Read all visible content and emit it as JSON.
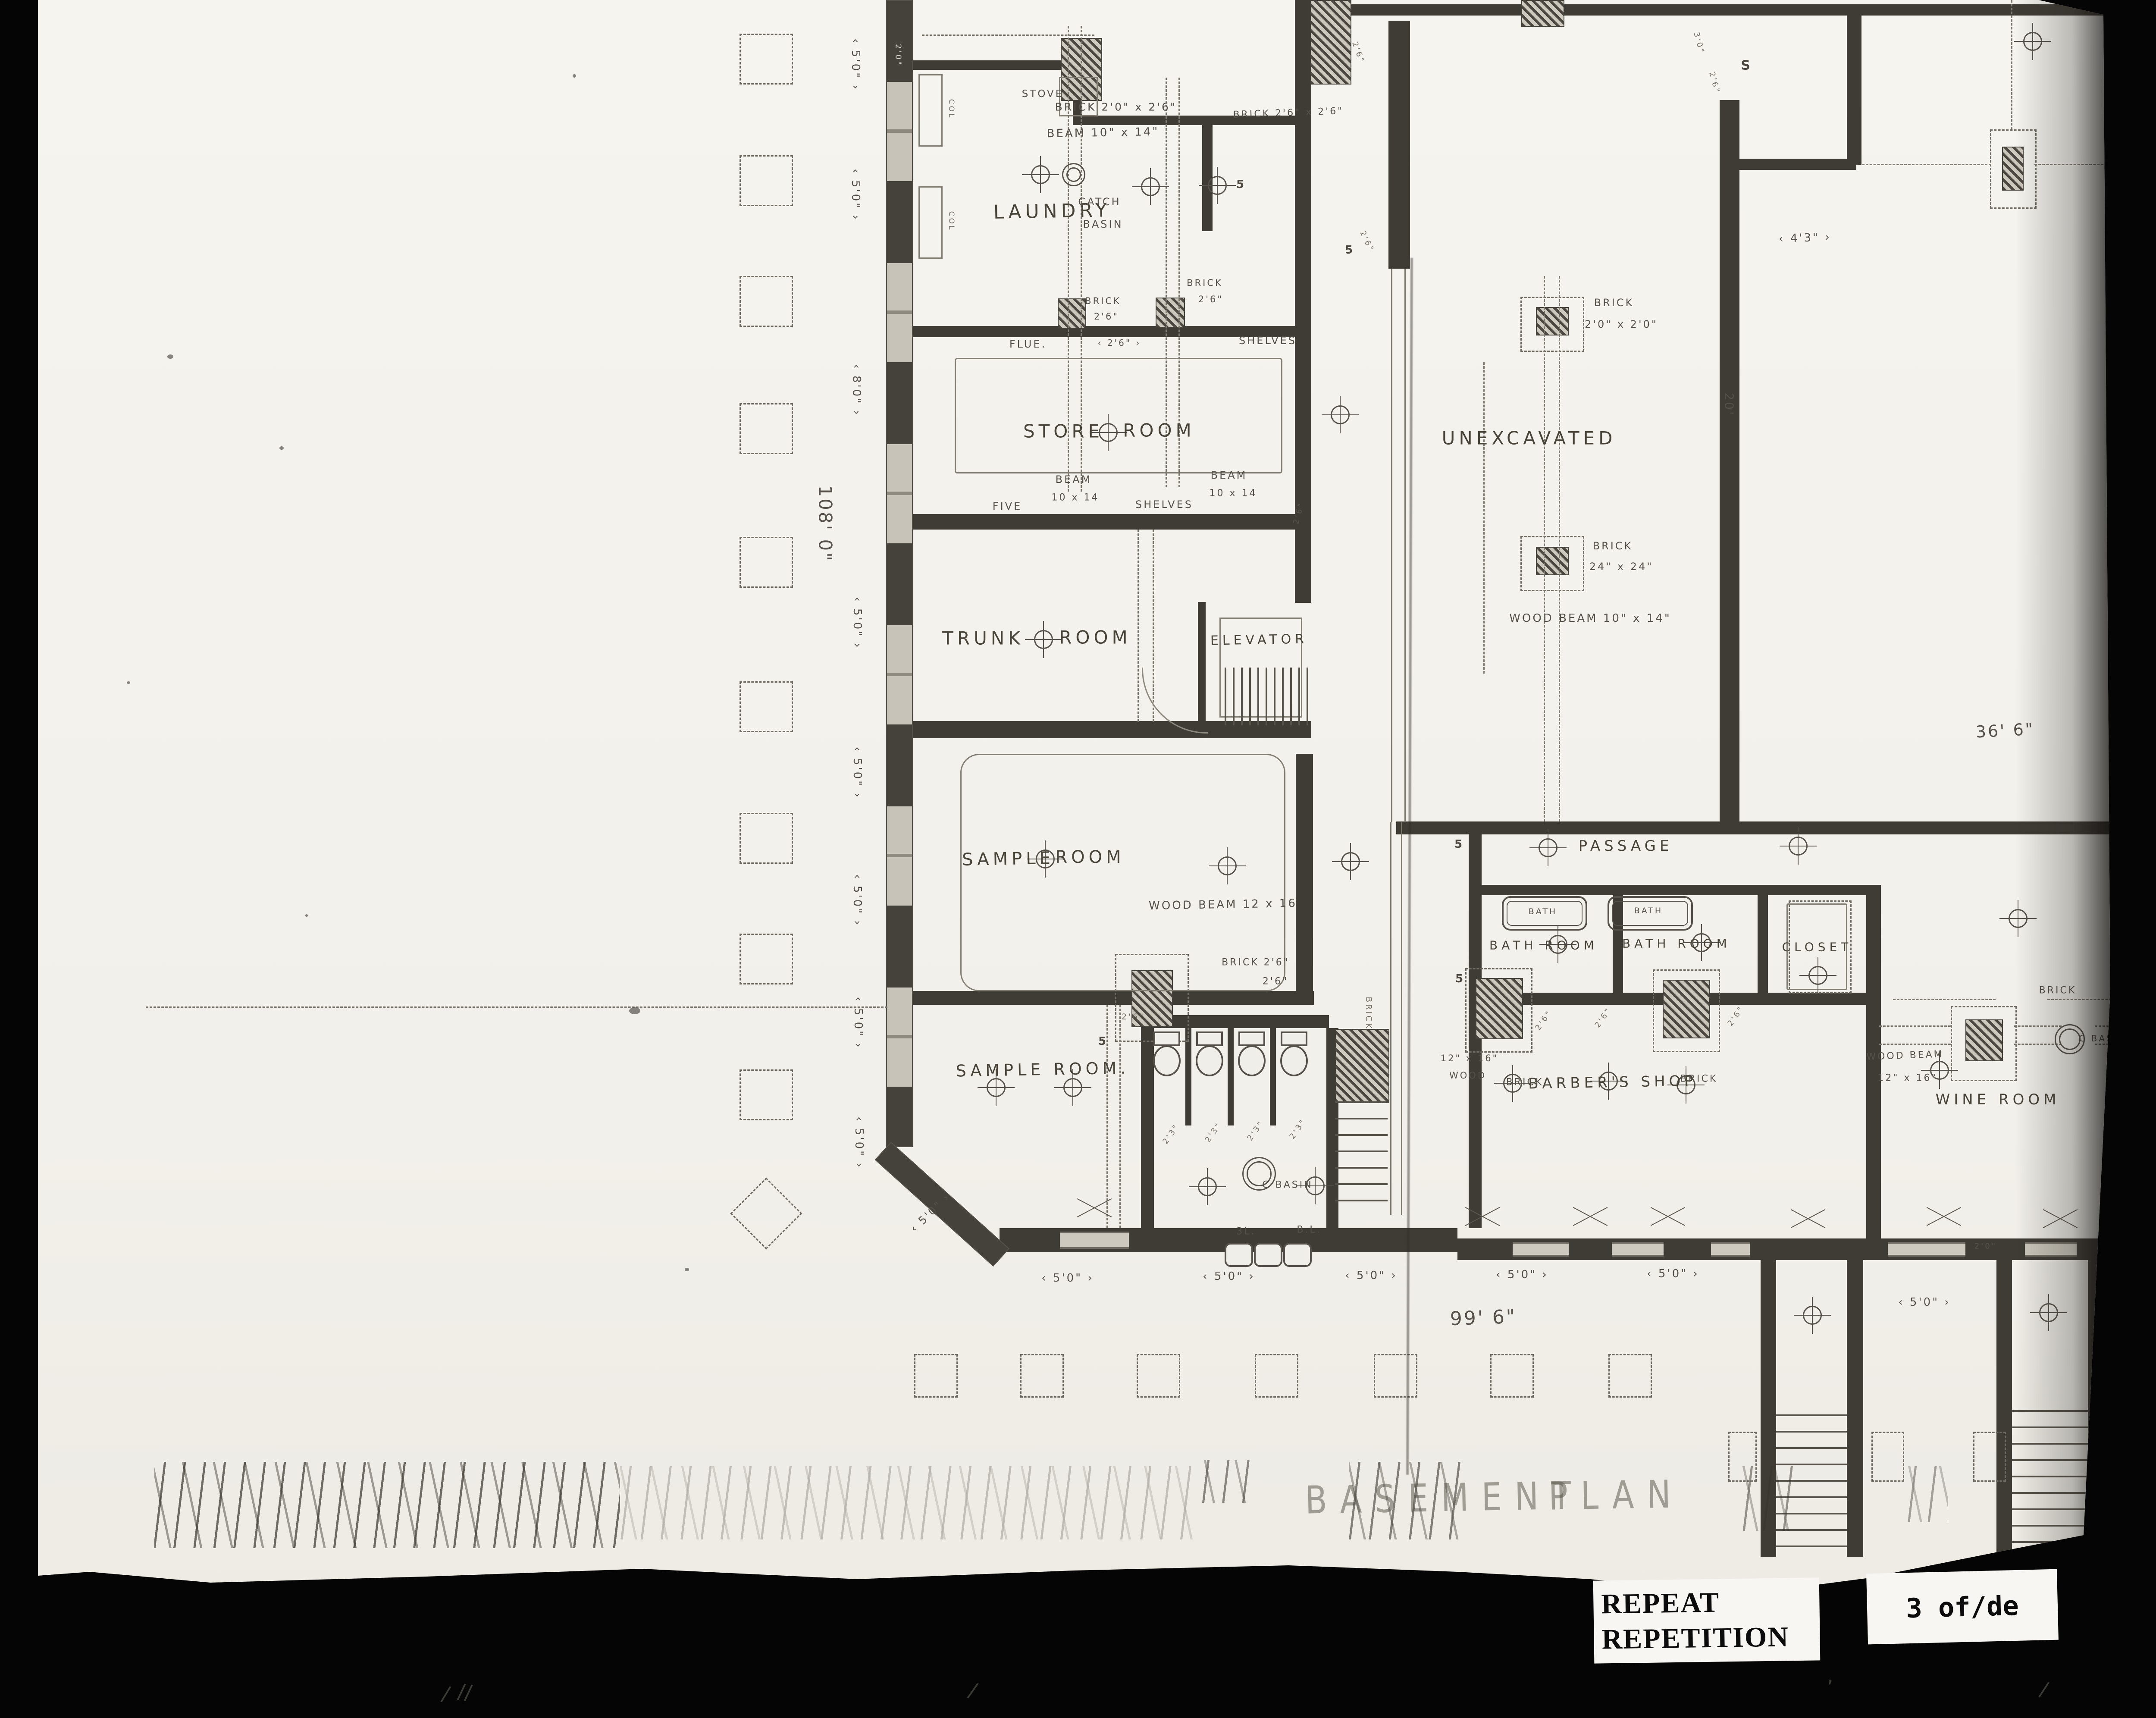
{
  "meta": {
    "background_color": "#050505",
    "paper_color": "#f3f1ea",
    "pencil_color": "#49453e",
    "wall_color": "#3f3b35"
  },
  "stamp": {
    "line1": "REPEAT",
    "line2": "REPETITION"
  },
  "page_stamp": "3 of/de",
  "labels": [
    [
      "LAUNDRY",
      2352,
      490,
      44,
      -1,
      "room"
    ],
    [
      "CATCH",
      2462,
      468,
      24,
      0,
      "ann"
    ],
    [
      "BASIN",
      2470,
      520,
      24,
      0,
      "ann"
    ],
    [
      "STORE",
      2378,
      1000,
      42,
      0,
      "room"
    ],
    [
      "ROOM",
      2600,
      998,
      42,
      0,
      "room"
    ],
    [
      "TRUNK",
      2192,
      1480,
      42,
      0,
      "room"
    ],
    [
      "ROOM",
      2452,
      1478,
      42,
      0,
      "room"
    ],
    [
      "ELEVATOR",
      2832,
      1484,
      30,
      -1,
      "room"
    ],
    [
      "SAMPLE",
      2250,
      1992,
      40,
      -1,
      "room"
    ],
    [
      "ROOM",
      2440,
      1988,
      40,
      0,
      "room"
    ],
    [
      "SAMPLE ROOM.",
      2330,
      2480,
      38,
      -1,
      "room"
    ],
    [
      "UNEXCAVATED",
      3458,
      1016,
      42,
      0,
      "room"
    ],
    [
      "PASSAGE",
      3682,
      1962,
      34,
      0,
      "room"
    ],
    [
      "BATH ROOM",
      3492,
      2192,
      28,
      0,
      "room"
    ],
    [
      "BATH ROOM",
      3800,
      2188,
      28,
      0,
      "room"
    ],
    [
      "CLOSET",
      4126,
      2196,
      28,
      0,
      "room"
    ],
    [
      "BARBER'S SHOP",
      3652,
      2510,
      34,
      -1,
      "room"
    ],
    [
      "WINE ROOM",
      4545,
      2550,
      34,
      0,
      "room"
    ],
    [
      "BATH",
      3490,
      2114,
      19,
      0,
      "ann"
    ],
    [
      "BATH",
      3735,
      2112,
      19,
      0,
      "ann"
    ],
    [
      "STOVE",
      2330,
      218,
      23,
      0,
      "ann"
    ],
    [
      "BRICK 2'0\" x 2'6\"",
      2500,
      248,
      25,
      0,
      "ann"
    ],
    [
      "BEAM 10\" x 14\"",
      2470,
      308,
      26,
      -1,
      "ann"
    ],
    [
      "BRICK 2'6\" x 2'6\"",
      2900,
      262,
      22,
      -2,
      "ann"
    ],
    [
      "BRICK",
      2470,
      698,
      21,
      0,
      "ann"
    ],
    [
      "2'6\"",
      2478,
      734,
      21,
      0,
      "ann"
    ],
    [
      "BRICK",
      2706,
      656,
      21,
      0,
      "ann"
    ],
    [
      "2'6\"",
      2720,
      694,
      21,
      0,
      "ann"
    ],
    [
      "2'6\"",
      2508,
      795,
      20,
      0,
      "dim"
    ],
    [
      "FLUE.",
      2296,
      798,
      24,
      0,
      "ann"
    ],
    [
      "SHELVES",
      2852,
      790,
      24,
      0,
      "ann"
    ],
    [
      "BEAM",
      2402,
      1112,
      24,
      0,
      "ann"
    ],
    [
      "10 x 14",
      2406,
      1154,
      22,
      0,
      "ann"
    ],
    [
      "BEAM",
      2762,
      1102,
      24,
      0,
      "ann"
    ],
    [
      "10 x 14",
      2772,
      1144,
      22,
      0,
      "ann"
    ],
    [
      "FIVE",
      2248,
      1174,
      24,
      0,
      "ann"
    ],
    [
      "SHELVES",
      2612,
      1170,
      24,
      0,
      "ann"
    ],
    [
      "WOOD BEAM 12 x 16",
      2748,
      2098,
      26,
      -1,
      "ann"
    ],
    [
      "BRICK 2'6\"",
      2824,
      2232,
      22,
      0,
      "ann"
    ],
    [
      "2'6\"",
      2870,
      2276,
      22,
      0,
      "ann"
    ],
    [
      "2'6\"",
      2540,
      2358,
      19,
      0,
      "tiny"
    ],
    [
      "BRICK",
      3655,
      702,
      24,
      0,
      "ann"
    ],
    [
      "2'0\" x 2'0\"",
      3672,
      752,
      24,
      0,
      "ann"
    ],
    [
      "BRICK",
      3652,
      1266,
      24,
      0,
      "ann"
    ],
    [
      "24\" x 24\"",
      3672,
      1314,
      24,
      0,
      "ann"
    ],
    [
      "WOOD BEAM 10\" x 14\"",
      3600,
      1434,
      26,
      0,
      "ann"
    ],
    [
      "BRICK",
      3448,
      2510,
      22,
      0,
      "ann"
    ],
    [
      "BRICK",
      3852,
      2502,
      22,
      0,
      "ann"
    ],
    [
      "12\" x 16\"",
      3320,
      2454,
      21,
      0,
      "ann"
    ],
    [
      "WOOD",
      3316,
      2494,
      21,
      0,
      "ann"
    ],
    [
      "WOOD BEAM",
      4330,
      2448,
      22,
      -2,
      "ann"
    ],
    [
      "12\" x 16\"",
      4336,
      2500,
      22,
      0,
      "ann"
    ],
    [
      "BRICK",
      4684,
      2297,
      22,
      0,
      "ann"
    ],
    [
      "C BASIN",
      4788,
      2408,
      20,
      0,
      "ann"
    ],
    [
      "C BASIN",
      2898,
      2748,
      22,
      0,
      "ann"
    ],
    [
      "3L.",
      2802,
      2856,
      22,
      0,
      "ann"
    ],
    [
      "B.L.",
      2948,
      2852,
      22,
      0,
      "ann"
    ],
    [
      "BRICK",
      3086,
      2350,
      19,
      90,
      "tiny"
    ],
    [
      "2'0\"",
      1995,
      128,
      18,
      90,
      "wall"
    ],
    [
      "COL",
      2118,
      253,
      17,
      90,
      "tiny"
    ],
    [
      "COL",
      2118,
      513,
      17,
      90,
      "tiny"
    ],
    [
      "2'3\"",
      2628,
      2630,
      18,
      -55,
      "tiny"
    ],
    [
      "2'3\"",
      2726,
      2626,
      18,
      -55,
      "tiny"
    ],
    [
      "2'3\"",
      2824,
      2622,
      18,
      -55,
      "tiny"
    ],
    [
      "2'3\"",
      2922,
      2618,
      18,
      -55,
      "tiny"
    ],
    [
      "2'6\"",
      3492,
      2366,
      18,
      -55,
      "tiny"
    ],
    [
      "2'6\"",
      3630,
      2360,
      18,
      -55,
      "tiny"
    ],
    [
      "2'6\"",
      3938,
      2356,
      18,
      -55,
      "tiny"
    ],
    [
      "2'6\"",
      2924,
      1190,
      18,
      -75,
      "tiny"
    ],
    [
      "3'0\"",
      3852,
      100,
      18,
      75,
      "tiny"
    ],
    [
      "2'6\"",
      3888,
      192,
      18,
      75,
      "tiny"
    ],
    [
      "2'6\"",
      3062,
      122,
      18,
      70,
      "tiny"
    ],
    [
      "2'6\"",
      3082,
      560,
      18,
      65,
      "tiny"
    ],
    [
      "5",
      2790,
      428,
      26,
      0,
      "mark"
    ],
    [
      "5",
      3042,
      580,
      26,
      0,
      "mark"
    ],
    [
      "5",
      3296,
      1958,
      26,
      0,
      "mark"
    ],
    [
      "5",
      3298,
      2270,
      26,
      0,
      "mark"
    ],
    [
      "5",
      2470,
      2415,
      26,
      0,
      "mark"
    ],
    [
      "S",
      3962,
      152,
      30,
      0,
      "mark"
    ],
    [
      "5'0\"",
      1896,
      150,
      26,
      90,
      "dim"
    ],
    [
      "5'0\"",
      1896,
      452,
      26,
      90,
      "dim"
    ],
    [
      "8'0\"",
      1898,
      905,
      26,
      90,
      "dim"
    ],
    [
      "5'0\"",
      1900,
      1445,
      26,
      90,
      "dim"
    ],
    [
      "5'0\"",
      1900,
      1792,
      26,
      90,
      "dim"
    ],
    [
      "5'0\"",
      1900,
      2088,
      26,
      90,
      "dim"
    ],
    [
      "5'0\"",
      1902,
      2372,
      26,
      90,
      "dim"
    ],
    [
      "5'0\"",
      1904,
      2650,
      26,
      90,
      "dim"
    ],
    [
      "108' 0\"",
      1826,
      1215,
      42,
      90,
      "ann"
    ],
    [
      "5'0\"",
      2070,
      2812,
      25,
      -44,
      "dim"
    ],
    [
      "5'0\"",
      2388,
      2964,
      26,
      0,
      "dim"
    ],
    [
      "5'0\"",
      2762,
      2960,
      26,
      0,
      "dim"
    ],
    [
      "5'0\"",
      3092,
      2958,
      26,
      0,
      "dim"
    ],
    [
      "5'0\"",
      3442,
      2956,
      26,
      0,
      "dim"
    ],
    [
      "5'0\"",
      3792,
      2954,
      26,
      0,
      "dim"
    ],
    [
      "5'0\"",
      4375,
      3020,
      26,
      0,
      "dim"
    ],
    [
      "99' 6\"",
      3352,
      3056,
      44,
      -2,
      "ann"
    ],
    [
      "2'0\"",
      4517,
      2890,
      18,
      0,
      "tiny"
    ],
    [
      "36' 6\"",
      4562,
      1694,
      38,
      -3,
      "ann"
    ],
    [
      "20'",
      3922,
      938,
      28,
      90,
      "ann"
    ],
    [
      "4'3\"",
      4098,
      552,
      26,
      -2,
      "dim"
    ],
    [
      "BASEMENT",
      3262,
      3474,
      74,
      -1,
      "title"
    ],
    [
      "PLAN",
      3660,
      3468,
      74,
      -1,
      "title"
    ]
  ]
}
